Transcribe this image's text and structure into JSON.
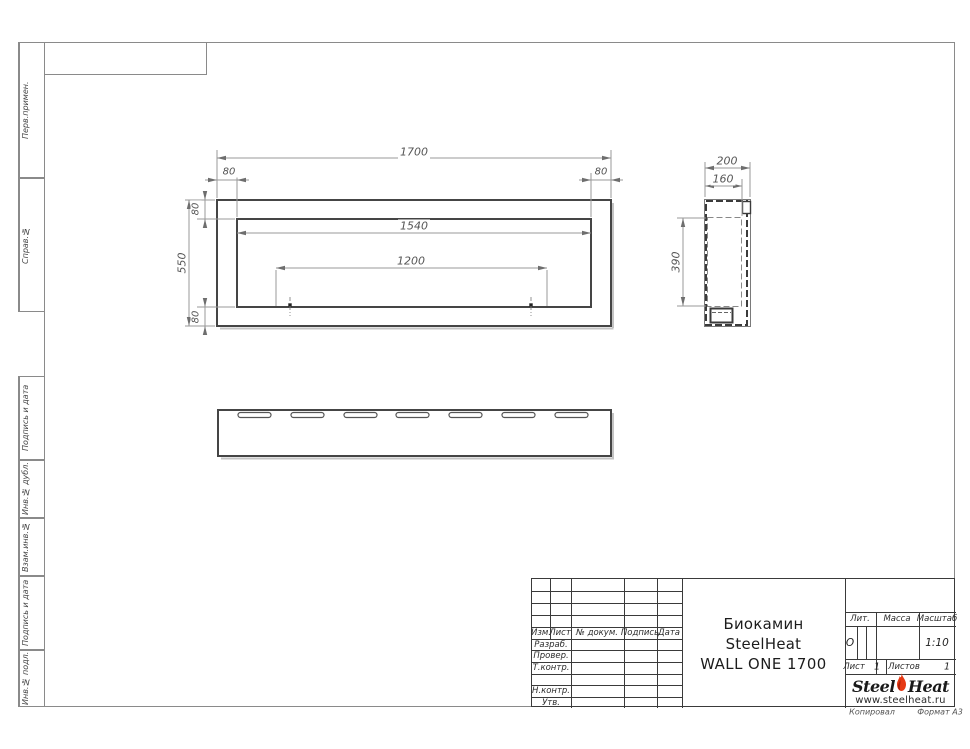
{
  "sheet": {
    "copied_label": "Копировал",
    "format_label": "Формат А3"
  },
  "side_strip": {
    "items": [
      {
        "label": "Перв.примен."
      },
      {
        "label": "Справ.№"
      },
      {
        "label": "Подпись и дата"
      },
      {
        "label": "Инв.№ дубл."
      },
      {
        "label": "Взам.инв.№"
      },
      {
        "label": "Подпись и дата"
      },
      {
        "label": "Инв.№ подл."
      }
    ]
  },
  "views": {
    "front": {
      "overall_width": "1700",
      "left_offset": "80",
      "right_offset": "80",
      "top_offset": "80",
      "overall_height": "550",
      "opening_width": "1540",
      "mount_spacing": "1200",
      "bottom_offset": "80"
    },
    "side": {
      "overall_depth": "200",
      "inner_depth": "160",
      "inner_height": "390"
    }
  },
  "title_block": {
    "col_izm": "Изм.",
    "col_list": "Лист",
    "col_doc": "№ докум.",
    "col_sign": "Подпись",
    "col_date": "Дата",
    "row_razrab": "Разраб.",
    "row_prover": "Провер.",
    "row_tkontr": "Т.контр.",
    "row_nkontr": "Н.контр.",
    "row_utv": "Утв.",
    "title_line1": "Биокамин SteelHeat",
    "title_line2": "WALL ONE 1700",
    "lit_label": "Лит.",
    "lit_value": "О",
    "mass_label": "Масса",
    "scale_label": "Масштаб",
    "scale_value": "1:10",
    "sheet_label": "Лист",
    "sheet_value": "1",
    "sheets_label": "Листов",
    "sheets_value": "1"
  },
  "logo": {
    "word1": "Steel",
    "word2": "Heat",
    "url": "www.steelheat.ru",
    "flame_color": "#e63914"
  }
}
